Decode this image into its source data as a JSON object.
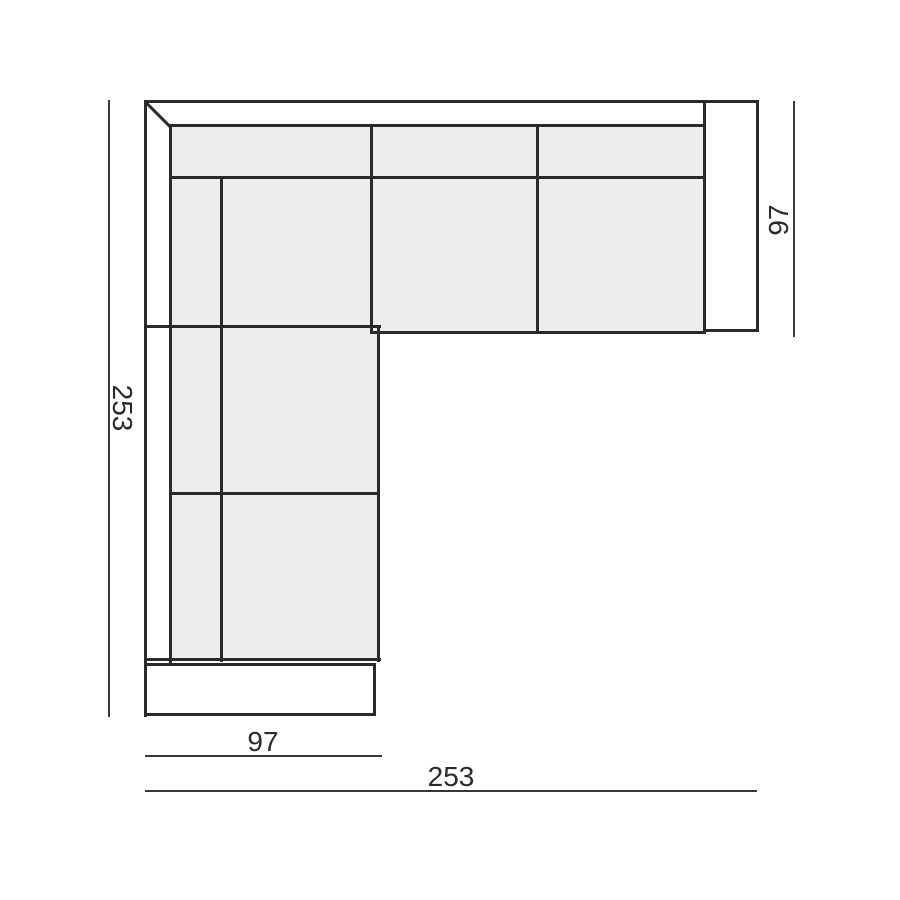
{
  "diagram": {
    "type": "sofa-sectional-top-view",
    "description": "Technical top-view dimension drawing of an L-shaped corner sofa",
    "labels": {
      "left_height": "253",
      "right_depth": "97",
      "bottom_left_width": "97",
      "bottom_total_width": "253"
    }
  },
  "colors": {
    "line": "#2a2a2c",
    "fill": "#ededee",
    "dimension_line": "#38383a",
    "text": "#2a2a2c",
    "background": "#ffffff"
  }
}
